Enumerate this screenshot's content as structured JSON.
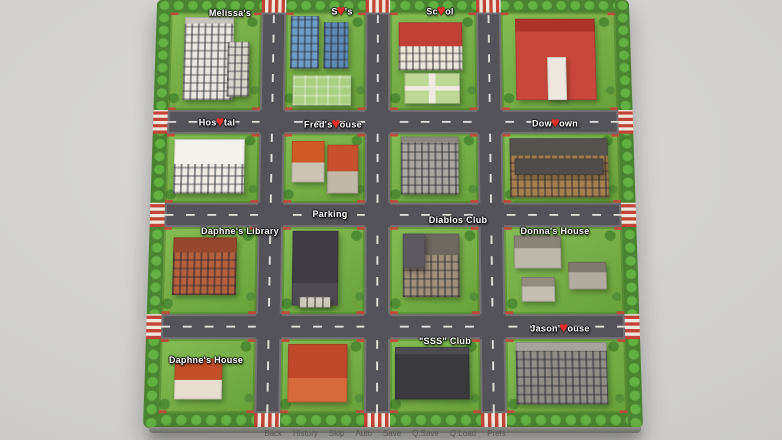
{
  "colors": {
    "background": "#cdccca",
    "grass": "#6ea644",
    "tree_border": "#4a8531",
    "road": "#55535a",
    "road_dash": "#dedcd6",
    "crosswalk_red": "#c24335",
    "crosswalk_white": "#eee8dd",
    "heart": "#e5312b",
    "label_text": "#ffffff"
  },
  "map": {
    "labels": [
      {
        "id": "melissas",
        "pre": "Melissa's",
        "heart": "",
        "post": "",
        "x": 230,
        "y": 13
      },
      {
        "id": "sams",
        "pre": "S",
        "heart": "♥",
        "post": "'s",
        "x": 342,
        "y": 11
      },
      {
        "id": "school",
        "pre": "Sc",
        "heart": "♥",
        "post": "ol",
        "x": 440,
        "y": 11
      },
      {
        "id": "hospital",
        "pre": "Hos",
        "heart": "♥",
        "post": "tal",
        "x": 217,
        "y": 122
      },
      {
        "id": "freds-house",
        "pre": "Fred's ",
        "heart": "♥",
        "post": "ouse",
        "x": 333,
        "y": 124
      },
      {
        "id": "downtown",
        "pre": "Dow",
        "heart": "♥",
        "post": "own",
        "x": 555,
        "y": 123
      },
      {
        "id": "parking",
        "pre": "Parking",
        "heart": "",
        "post": "",
        "x": 330,
        "y": 214
      },
      {
        "id": "diablos-club",
        "pre": "Diablos Club",
        "heart": "",
        "post": "",
        "x": 458,
        "y": 220
      },
      {
        "id": "daphnes-library",
        "pre": "Daphne's Library",
        "heart": "",
        "post": "",
        "x": 240,
        "y": 231
      },
      {
        "id": "donnas-house",
        "pre": "Donna's House",
        "heart": "",
        "post": "",
        "x": 555,
        "y": 231
      },
      {
        "id": "jasons-house",
        "pre": "Jason'",
        "heart": "♥",
        "post": "ouse",
        "x": 560,
        "y": 328
      },
      {
        "id": "sss-club",
        "pre": "\"SSS\" Club",
        "heart": "",
        "post": "",
        "x": 445,
        "y": 341
      },
      {
        "id": "daphnes-house",
        "pre": "Daphne's House",
        "heart": "",
        "post": "",
        "x": 206,
        "y": 360
      }
    ]
  },
  "blocks": [
    {
      "r": 0,
      "c": 0,
      "name": "melissas",
      "shapes": [
        {
          "x": 16,
          "y": 5,
          "w": 54,
          "h": 85,
          "bg": "#e9e7e0",
          "top": "#c7c3ba",
          "topH": 8,
          "pat": "win"
        },
        {
          "x": 64,
          "y": 30,
          "w": 24,
          "h": 56,
          "bg": "#d8d5cc",
          "pat": "win"
        }
      ]
    },
    {
      "r": 0,
      "c": 1,
      "name": "sams",
      "shapes": [
        {
          "x": 6,
          "y": 4,
          "w": 36,
          "h": 54,
          "bg": "#6f9dc9",
          "pat": "win"
        },
        {
          "x": 48,
          "y": 10,
          "w": 30,
          "h": 48,
          "bg": "#5d89b7",
          "pat": "win"
        },
        {
          "x": 10,
          "y": 64,
          "w": 72,
          "h": 31,
          "bg": "#aacf81",
          "pat": "garden"
        }
      ]
    },
    {
      "r": 0,
      "c": 2,
      "name": "school",
      "shapes": [
        {
          "x": 10,
          "y": 10,
          "w": 74,
          "h": 50,
          "bg": "#ece5d9",
          "top": "#c04034",
          "topH": 50,
          "pat": "win"
        },
        {
          "x": 16,
          "y": 62,
          "w": 64,
          "h": 32,
          "bg": "#bfd795",
          "pat": "cross"
        }
      ]
    },
    {
      "r": 0,
      "c": 3,
      "name": "church",
      "shapes": [
        {
          "x": 12,
          "y": 6,
          "w": 70,
          "h": 84,
          "bg": "#c8473a",
          "top": "#ad3429",
          "topH": 16
        },
        {
          "x": 40,
          "y": 46,
          "w": 16,
          "h": 44,
          "bg": "#ece7df"
        }
      ]
    },
    {
      "r": 1,
      "c": 0,
      "name": "hospital",
      "shapes": [
        {
          "x": 8,
          "y": 8,
          "w": 76,
          "h": 78,
          "bg": "#eeece5",
          "top": "#f4f2ec",
          "topH": 46,
          "pat": "win"
        }
      ]
    },
    {
      "r": 1,
      "c": 1,
      "name": "freds-house",
      "shapes": [
        {
          "x": 10,
          "y": 10,
          "w": 40,
          "h": 60,
          "bg": "#cbc3b4",
          "top": "#cf5a28",
          "topH": 52
        },
        {
          "x": 54,
          "y": 16,
          "w": 38,
          "h": 70,
          "bg": "#c0b7a7",
          "top": "#c8502c",
          "topH": 55
        }
      ]
    },
    {
      "r": 1,
      "c": 2,
      "name": "apartment",
      "shapes": [
        {
          "x": 12,
          "y": 4,
          "w": 66,
          "h": 84,
          "bg": "#a9a5a0",
          "top": "#8c8881",
          "topH": 10,
          "pat": "win"
        }
      ]
    },
    {
      "r": 1,
      "c": 3,
      "name": "downtown",
      "shapes": [
        {
          "x": 6,
          "y": 6,
          "w": 84,
          "h": 86,
          "bg": "#a57e4e",
          "top": "#56534e",
          "topH": 30,
          "pat": "win"
        },
        {
          "x": 10,
          "y": 36,
          "w": 76,
          "h": 24,
          "bg": "#504d4a"
        }
      ]
    },
    {
      "r": 2,
      "c": 0,
      "name": "daphnes-library",
      "shapes": [
        {
          "x": 10,
          "y": 12,
          "w": 68,
          "h": 66,
          "bg": "#b2613c",
          "top": "#96482c",
          "topH": 26,
          "pat": "win"
        }
      ]
    },
    {
      "r": 2,
      "c": 1,
      "name": "parking",
      "shapes": [
        {
          "x": 12,
          "y": 4,
          "w": 56,
          "h": 86,
          "bg": "#4e4c52",
          "top": "#3e3c42",
          "topH": 70
        },
        {
          "x": 20,
          "y": 80,
          "w": 40,
          "h": 12,
          "bg": "#cfc9bd",
          "pat": "lines"
        }
      ]
    },
    {
      "r": 2,
      "c": 2,
      "name": "diablos-club",
      "shapes": [
        {
          "x": 14,
          "y": 8,
          "w": 64,
          "h": 72,
          "bg": "#a08f7b",
          "top": "#6e6861",
          "topH": 34,
          "pat": "win"
        },
        {
          "x": 14,
          "y": 8,
          "w": 26,
          "h": 40,
          "bg": "#5c5a60"
        }
      ]
    },
    {
      "r": 2,
      "c": 3,
      "name": "donnas-house",
      "shapes": [
        {
          "x": 8,
          "y": 10,
          "w": 40,
          "h": 38,
          "bg": "#bdb7ac",
          "top": "#8a8478",
          "topH": 38
        },
        {
          "x": 54,
          "y": 40,
          "w": 32,
          "h": 32,
          "bg": "#b1aba0",
          "top": "#7f7a6f",
          "topH": 38
        },
        {
          "x": 14,
          "y": 58,
          "w": 28,
          "h": 28,
          "bg": "#c3bdb2",
          "top": "#938d81",
          "topH": 38
        }
      ]
    },
    {
      "r": 3,
      "c": 0,
      "name": "daphnes-house",
      "shapes": [
        {
          "x": 16,
          "y": 26,
          "w": 50,
          "h": 56,
          "bg": "#e6ddcf",
          "top": "#c44f27",
          "topH": 52
        }
      ]
    },
    {
      "r": 3,
      "c": 1,
      "name": "big-house",
      "shapes": [
        {
          "x": 8,
          "y": 6,
          "w": 72,
          "h": 80,
          "bg": "#d8693c",
          "top": "#c0482a",
          "topH": 58
        }
      ]
    },
    {
      "r": 3,
      "c": 2,
      "name": "sss-club",
      "shapes": [
        {
          "x": 6,
          "y": 10,
          "w": 82,
          "h": 72,
          "bg": "#3a393e",
          "top": "#4c4b52",
          "topH": 14
        }
      ]
    },
    {
      "r": 3,
      "c": 3,
      "name": "jasons-house",
      "shapes": [
        {
          "x": 8,
          "y": 4,
          "w": 76,
          "h": 84,
          "bg": "#908d87",
          "top": "#a7a49e",
          "topH": 14,
          "pat": "win"
        }
      ]
    }
  ],
  "quick_menu": {
    "items": [
      "Back",
      "History",
      "Skip",
      "Auto",
      "Save",
      "Q.Save",
      "Q.Load",
      "Prefs"
    ]
  }
}
